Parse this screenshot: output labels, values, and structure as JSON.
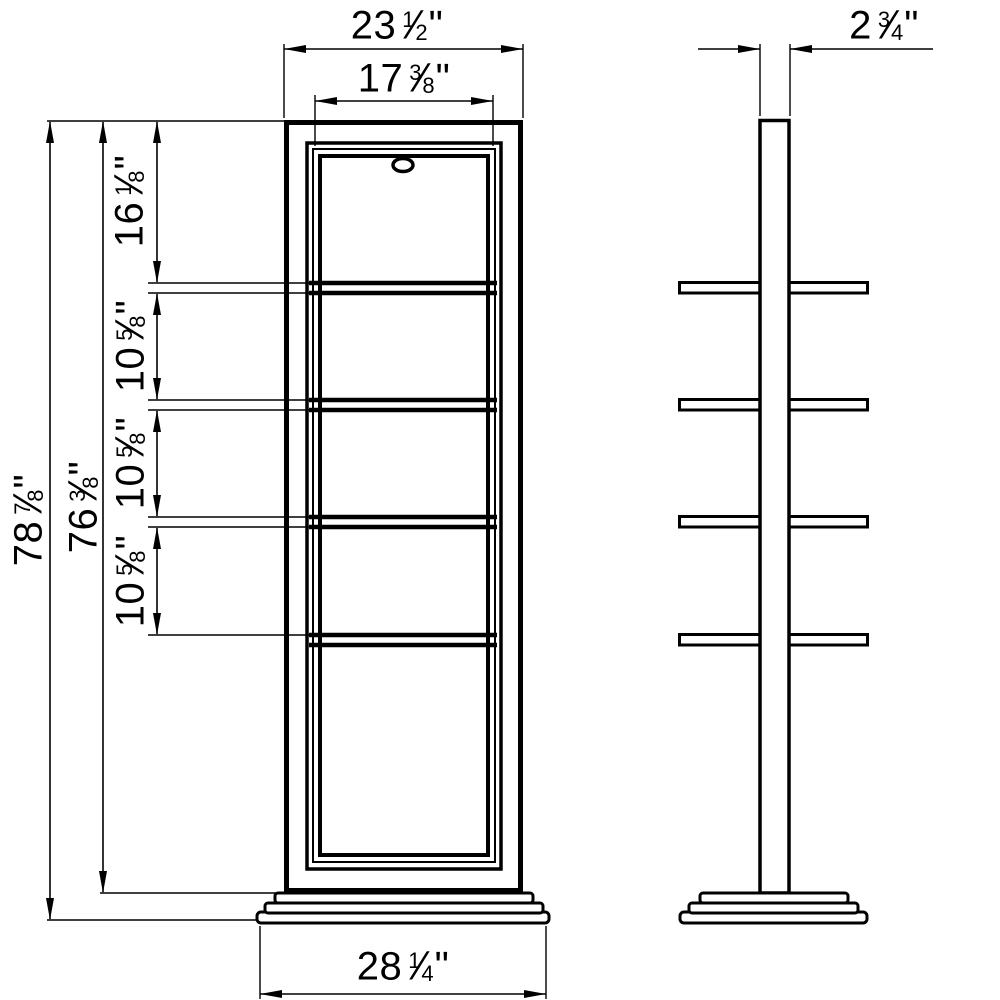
{
  "drawing": {
    "background_color": "#ffffff",
    "line_color": "#000000",
    "views": {
      "front_label": "front view of shelf cabinet",
      "side_label": "side view of shelf cabinet"
    }
  },
  "dims": {
    "fraction_slash": "⁄",
    "top_width": {
      "whole": "23",
      "num": "1",
      "den": "2",
      "unit": "\""
    },
    "inner_width": {
      "whole": "17",
      "num": "3",
      "den": "8",
      "unit": "\""
    },
    "overall_height": {
      "whole": "78",
      "num": "7",
      "den": "8",
      "unit": "\""
    },
    "body_height": {
      "whole": "76",
      "num": "3",
      "den": "8",
      "unit": "\""
    },
    "top_section_height": {
      "whole": "16",
      "num": "1",
      "den": "8",
      "unit": "\""
    },
    "shelf_spacing_1": {
      "whole": "10",
      "num": "5",
      "den": "8",
      "unit": "\""
    },
    "shelf_spacing_2": {
      "whole": "10",
      "num": "5",
      "den": "8",
      "unit": "\""
    },
    "shelf_spacing_3": {
      "whole": "10",
      "num": "5",
      "den": "8",
      "unit": "\""
    },
    "base_width": {
      "whole": "28",
      "num": "1",
      "den": "4",
      "unit": "\""
    },
    "side_depth": {
      "whole": "2",
      "num": "3",
      "den": "4",
      "unit": "\""
    }
  }
}
